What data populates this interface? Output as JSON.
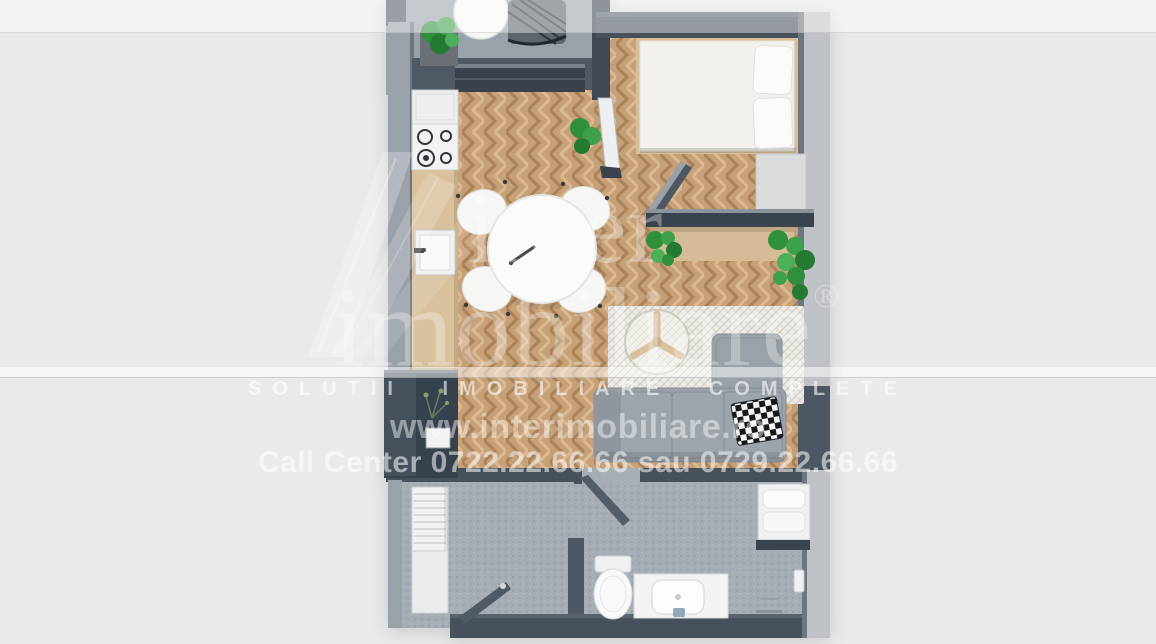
{
  "watermark": {
    "logo_line1": "inter",
    "logo_line2": "imobiliare",
    "registered_mark": "®",
    "slogan": "SOLUTII IMOBILIARE COMPLETE",
    "website": "www.interimobiliare.ro",
    "call_center": "Call Center 0722.22.66.66 sau 0729.22.66.66"
  },
  "palette": {
    "background": "#e9eaeb",
    "wall_dark": "#47515c",
    "wall_light": "#bfc3c7",
    "wood_floor": "#c6a078",
    "counter_wood": "#d9c19c",
    "balcony_floor": "#9ba1a9",
    "bathroom_floor": "#a6adb5",
    "sofa_gray": "#9aa1a8",
    "rug": "#edece7",
    "plant_green": "#3da04a",
    "furniture_white": "#f4f4f3",
    "console_dark": "#36414e",
    "watermark_white": "#ffffff"
  },
  "objects": [
    "balcony-lounge-chair",
    "balcony-table",
    "balcony-plant",
    "storage-bench",
    "double-bed",
    "bed-pillows",
    "bedside-bench",
    "kitchen-fridge",
    "kitchen-cooktop",
    "kitchen-counter",
    "kitchen-sink",
    "dining-table",
    "dining-chair",
    "balcony-door",
    "indoor-plant",
    "desk-partition",
    "desk-shelf",
    "area-rug",
    "coffee-table",
    "sofa",
    "checkered-pillow",
    "tv-console",
    "bathroom-door",
    "entrance-door",
    "radiator",
    "hall-cabinet",
    "toilet",
    "vanity-sink",
    "towel-shelf",
    "floor-drain"
  ]
}
